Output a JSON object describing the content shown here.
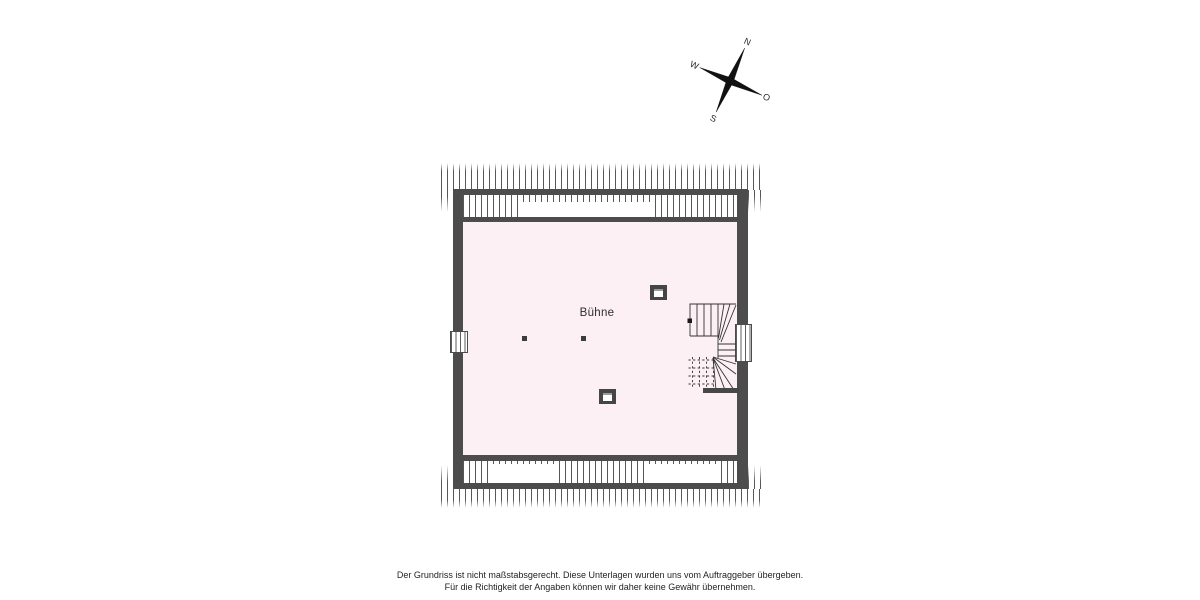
{
  "plan": {
    "room_label": "Bühne",
    "features": [
      "roof-hatching",
      "dormer-gaps",
      "left-window",
      "right-window",
      "chimney-upper",
      "chimney-lower",
      "support-posts",
      "winder-staircase"
    ]
  },
  "compass": {
    "north": "N",
    "east": "O",
    "south": "S",
    "west": "W",
    "rotation_deg": 24
  },
  "footer": {
    "line1": "Der Grundriss ist nicht maßstabsgerecht. Diese Unterlagen wurden uns vom Auftraggeber übergeben.",
    "line2": "Für die Richtigkeit der Angaben können wir daher keine Gewähr übernehmen."
  },
  "colors": {
    "wall": "#4c4c4c",
    "interior_fill": "#fcf0f4",
    "hatch_line": "#3a3a3a",
    "stair_line": "#333333",
    "background": "#ffffff",
    "compass_fill": "#111111"
  }
}
